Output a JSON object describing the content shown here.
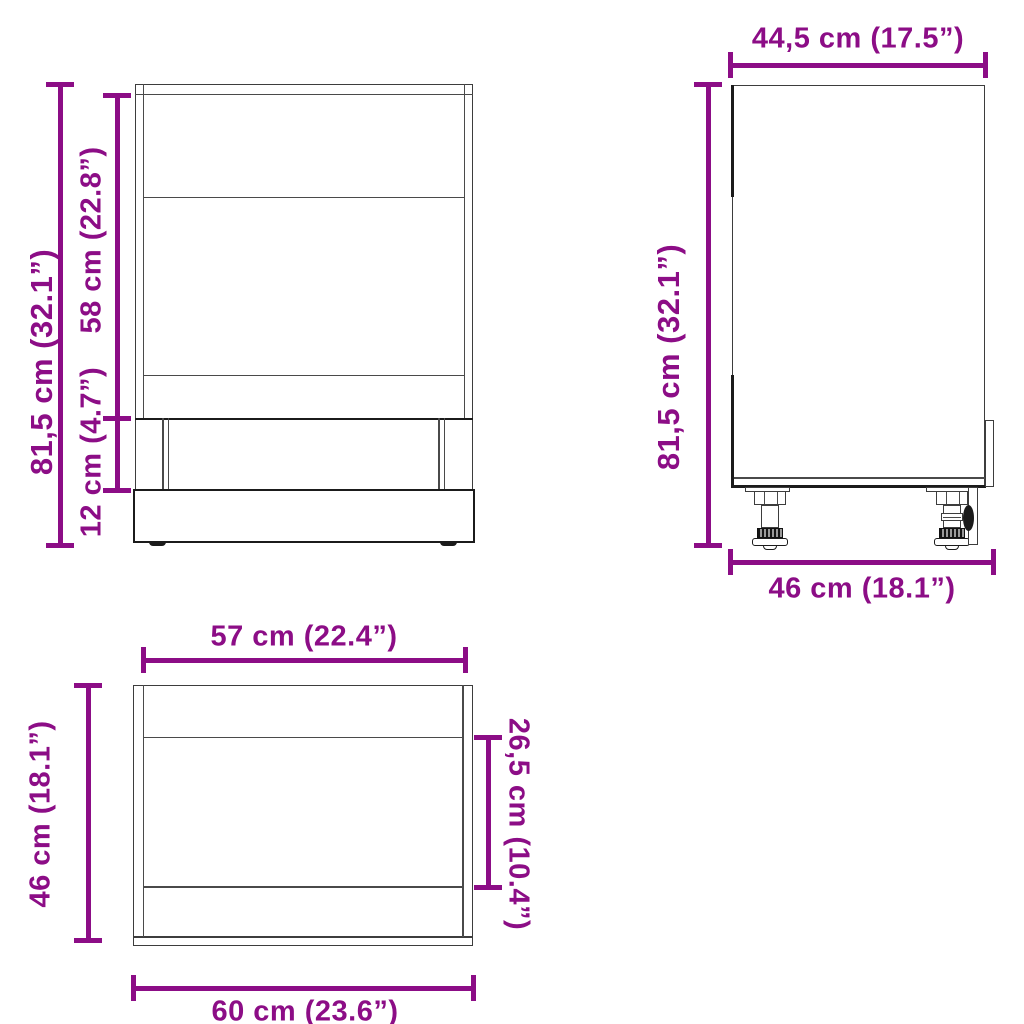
{
  "palette": {
    "dimension_color": "#8c0d86",
    "line_color": "#4a4a4a",
    "heavy_line_color": "#1b1b1b",
    "background": "#ffffff"
  },
  "views": {
    "front": {
      "dimensions": {
        "total_height": "81,5 cm (32.1”)",
        "niche_height": "58 cm (22.8”)",
        "plinth_height": "12 cm (4.7”)"
      }
    },
    "side": {
      "dimensions": {
        "depth_without_front": "44,5 cm (17.5”)",
        "total_height": "81,5 cm (32.1”)",
        "depth_with_front": "46 cm (18.1”)"
      }
    },
    "top": {
      "dimensions": {
        "inner_width": "57 cm (22.4”)",
        "depth": "46 cm (18.1”)",
        "recess_depth": "26,5 cm (10.4”)",
        "outer_width": "60 cm (23.6”)"
      }
    }
  }
}
